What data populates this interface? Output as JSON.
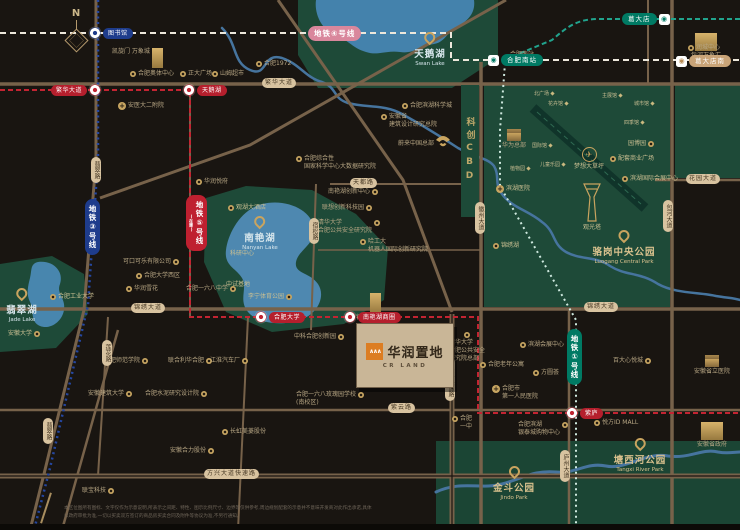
{
  "title": "华润置地 合肥区位图",
  "compass": "N",
  "project": {
    "name": "华润置地",
    "en": "CR LAND",
    "logo_mark": "∧∧∧"
  },
  "banner": {
    "text": "科创CBD"
  },
  "colors": {
    "background": "#191511",
    "park_green": "#1e4a38",
    "lake_blue": "#4886ae",
    "road_tan": "#77624a",
    "pill_tan": "#d8c3a0",
    "gold": "#c9a45f",
    "line1_teal": "#007a64",
    "line3_blue": "#1e3c8c",
    "line4_pink": "#d9879c",
    "line5_red": "#bf2030"
  },
  "metro_labels": [
    {
      "t": "地铁④号线",
      "x": 308,
      "y": 26,
      "v": 0,
      "color": "#d9879c"
    },
    {
      "t": "地铁③号线",
      "x": 85,
      "y": 199,
      "v": 1,
      "color": "#1e3c8c"
    },
    {
      "t": "地铁⑤号线",
      "sub": "(在建)",
      "x": 186,
      "y": 195,
      "v": 1,
      "color": "#bf2030"
    },
    {
      "t": "地铁①号线",
      "x": 567,
      "y": 329,
      "v": 1,
      "color": "#007a64"
    }
  ],
  "road_labels": [
    {
      "t": "繁华大道",
      "x": 262,
      "y": 78,
      "v": 0
    },
    {
      "t": "锦绣大道",
      "x": 131,
      "y": 303,
      "v": 0
    },
    {
      "t": "锦绣大道",
      "x": 584,
      "y": 302,
      "v": 0
    },
    {
      "t": "花园大道",
      "x": 686,
      "y": 174,
      "v": 0
    },
    {
      "t": "天都路",
      "x": 350,
      "y": 178,
      "v": 0
    },
    {
      "t": "紫云路",
      "x": 388,
      "y": 403,
      "v": 0
    },
    {
      "t": "方兴大道快速路",
      "x": 204,
      "y": 469,
      "v": 0
    },
    {
      "t": "翡翠路",
      "x": 91,
      "y": 157,
      "v": 1
    },
    {
      "t": "莲花路",
      "x": 102,
      "y": 340,
      "v": 1
    },
    {
      "t": "翡翠路",
      "x": 43,
      "y": 418,
      "v": 1
    },
    {
      "t": "宿松路",
      "x": 309,
      "y": 218,
      "v": 1
    },
    {
      "t": "宿松路快速路",
      "x": 445,
      "y": 357,
      "v": 1
    },
    {
      "t": "徽州大道",
      "x": 475,
      "y": 202,
      "v": 1
    },
    {
      "t": "包河大道",
      "x": 663,
      "y": 200,
      "v": 1
    },
    {
      "t": "庐州大道",
      "x": 560,
      "y": 450,
      "v": 1
    }
  ],
  "stations": [
    {
      "n": "图书馆",
      "x": 95,
      "y": 33,
      "k": "blue",
      "side": "r"
    },
    {
      "n": "繁华大道",
      "x": 95,
      "y": 90,
      "k": "red",
      "side": "l"
    },
    {
      "n": "天鹅湖",
      "x": 189,
      "y": 90,
      "k": "red",
      "side": "r"
    },
    {
      "n": "合肥大学",
      "x": 261,
      "y": 317,
      "k": "red",
      "side": "r"
    },
    {
      "n": "南艳湖商圈",
      "x": 350,
      "y": 317,
      "k": "red",
      "side": "r"
    },
    {
      "n": "紫庐",
      "x": 572,
      "y": 413,
      "k": "red",
      "side": "r"
    },
    {
      "n": "葛大店",
      "x": 622,
      "y": 13,
      "k": "teal",
      "side": "badge-r"
    },
    {
      "n": "合肥南站",
      "x": 488,
      "y": 54,
      "k": "teal",
      "side": "badge-l"
    },
    {
      "n": "葛大店南",
      "x": 676,
      "y": 55,
      "k": "tan",
      "side": "badge-l"
    }
  ],
  "area_names": [
    {
      "t": "天鹅湖",
      "en": "Swan Lake",
      "x": 430,
      "y": 30,
      "c": "blue"
    },
    {
      "t": "南艳湖",
      "en": "Nanyan Lake",
      "x": 260,
      "y": 214,
      "c": "blue"
    },
    {
      "t": "翡翠湖",
      "en": "Jade Lake",
      "x": 22,
      "y": 286,
      "c": "blue"
    },
    {
      "t": "骆岗中央公园",
      "en": "Luogang Central Park",
      "x": 624,
      "y": 228,
      "c": "gold"
    },
    {
      "t": "塘西河公园",
      "en": "Tangxi River Park",
      "x": 640,
      "y": 436,
      "c": "gold"
    },
    {
      "t": "金斗公园",
      "en": "Jindo Park",
      "x": 514,
      "y": 464,
      "c": "gold"
    }
  ],
  "pois": [
    {
      "l": [
        "凯旋门 万象城"
      ],
      "x": 112,
      "y": 48,
      "i": "bldg-tall",
      "s": "r"
    },
    {
      "l": [
        "合肥奥体中心"
      ],
      "x": 130,
      "y": 70,
      "i": "dot",
      "s": "l"
    },
    {
      "l": [
        "正大广场"
      ],
      "x": 180,
      "y": 70,
      "i": "dot",
      "s": "l"
    },
    {
      "l": [
        "山姆超市"
      ],
      "x": 212,
      "y": 70,
      "i": "dot",
      "s": "l"
    },
    {
      "l": [
        "安医大二附院"
      ],
      "x": 118,
      "y": 102,
      "i": "cross",
      "s": "l"
    },
    {
      "l": [
        "合肥1972"
      ],
      "x": 256,
      "y": 60,
      "i": "dot",
      "s": "l"
    },
    {
      "l": [
        "合肥滨湖科学城"
      ],
      "x": 402,
      "y": 102,
      "i": "dot",
      "s": "l"
    },
    {
      "l": [
        "安徽省",
        "建筑设计研究总院"
      ],
      "x": 381,
      "y": 113,
      "i": "dot",
      "s": "l"
    },
    {
      "l": [
        "蔚来中国总部"
      ],
      "x": 398,
      "y": 140,
      "i": "none",
      "s": "l"
    },
    {
      "l": [
        "合肥综合性",
        "国家科学中心大数据研究院"
      ],
      "x": 296,
      "y": 155,
      "i": "dot",
      "s": "l"
    },
    {
      "l": [
        "合肥南站"
      ],
      "x": 522,
      "y": 39,
      "i": "bldg-wide",
      "s": "t"
    },
    {
      "l": [
        "包河万象汇"
      ],
      "x": 706,
      "y": 33,
      "i": "bldg-big",
      "s": "t"
    },
    {
      "l": [
        "润城中心"
      ],
      "x": 688,
      "y": 44,
      "i": "dot",
      "s": "l"
    },
    {
      "l": [
        "华为总部"
      ],
      "x": 514,
      "y": 129,
      "i": "bldg",
      "s": "t"
    },
    {
      "l": [
        "可口可乐有限公司"
      ],
      "x": 123,
      "y": 258,
      "i": "dot",
      "s": "r"
    },
    {
      "l": [
        "合肥大学西区"
      ],
      "x": 136,
      "y": 272,
      "i": "dot",
      "s": "l"
    },
    {
      "l": [
        "华润雪花"
      ],
      "x": 126,
      "y": 285,
      "i": "dot",
      "s": "l"
    },
    {
      "l": [
        "合肥工业大学"
      ],
      "x": 50,
      "y": 293,
      "i": "dot",
      "s": "l",
      "g": 1
    },
    {
      "l": [
        "安徽大学"
      ],
      "x": 8,
      "y": 330,
      "i": "dot",
      "s": "r",
      "g": 1
    },
    {
      "l": [
        "华润悦府"
      ],
      "x": 196,
      "y": 178,
      "i": "dot",
      "s": "l"
    },
    {
      "l": [
        "观湖大酒店"
      ],
      "x": 228,
      "y": 204,
      "i": "dot",
      "s": "l",
      "g": 1
    },
    {
      "l": [
        "科研中心"
      ],
      "x": 230,
      "y": 250,
      "i": "none",
      "s": "l",
      "g": 1
    },
    {
      "l": [
        "中试基地"
      ],
      "x": 226,
      "y": 281,
      "i": "none",
      "s": "l",
      "g": 1
    },
    {
      "l": [
        "合肥一六八中学"
      ],
      "x": 186,
      "y": 285,
      "i": "dot",
      "s": "r"
    },
    {
      "l": [
        "李宁体育公园"
      ],
      "x": 248,
      "y": 293,
      "i": "dot",
      "s": "r",
      "g": 1
    },
    {
      "l": [
        "中科合肥创新园"
      ],
      "x": 294,
      "y": 333,
      "i": "dot",
      "s": "r"
    },
    {
      "l": [
        "南艳湖创新中心"
      ],
      "x": 328,
      "y": 188,
      "i": "dot",
      "s": "r"
    },
    {
      "l": [
        "联想创新科技园"
      ],
      "x": 322,
      "y": 204,
      "i": "dot",
      "s": "r"
    },
    {
      "l": [
        "清华大学",
        "合肥公共安全研究院"
      ],
      "x": 318,
      "y": 219,
      "i": "dot",
      "s": "r"
    },
    {
      "l": [
        "哈工大",
        "机器人国际创新研究院"
      ],
      "x": 360,
      "y": 238,
      "i": "dot",
      "s": "l"
    },
    {
      "l": [
        "银泰IN PARK!"
      ],
      "x": 375,
      "y": 293,
      "i": "bldg-tall",
      "s": "t"
    },
    {
      "l": [
        "清华大学",
        "合肥公共安全",
        "研究院总部"
      ],
      "x": 467,
      "y": 331,
      "i": "dot",
      "s": "t"
    },
    {
      "l": [
        "合肥一六八玫瑰园学校"
      ],
      "x": 372,
      "y": 379,
      "i": "dot",
      "s": "r"
    },
    {
      "l": [
        "合肥一六八玫瑰园学校",
        "(南校区)"
      ],
      "x": 296,
      "y": 391,
      "i": "dot",
      "s": "r"
    },
    {
      "l": [
        "合肥老年公寓"
      ],
      "x": 480,
      "y": 361,
      "i": "dot",
      "s": "l"
    },
    {
      "l": [
        "合肥市",
        "第一人民医院"
      ],
      "x": 492,
      "y": 385,
      "i": "cross",
      "s": "l"
    },
    {
      "l": [
        "合肥",
        "一中"
      ],
      "x": 452,
      "y": 415,
      "i": "dot",
      "s": "l"
    },
    {
      "l": [
        "滨湖会展中心"
      ],
      "x": 520,
      "y": 341,
      "i": "dot",
      "s": "l"
    },
    {
      "l": [
        "方圆荟"
      ],
      "x": 533,
      "y": 369,
      "i": "dot",
      "s": "l"
    },
    {
      "l": [
        "百大心悦城"
      ],
      "x": 613,
      "y": 357,
      "i": "dot",
      "s": "r"
    },
    {
      "l": [
        "安徽省立医院"
      ],
      "x": 712,
      "y": 355,
      "i": "bldg",
      "s": "t"
    },
    {
      "l": [
        "悦方ID MALL"
      ],
      "x": 594,
      "y": 419,
      "i": "dot",
      "s": "l"
    },
    {
      "l": [
        "合肥滨湖",
        "银泰城购物中心"
      ],
      "x": 518,
      "y": 421,
      "i": "dot",
      "s": "r"
    },
    {
      "l": [
        "安徽省政府"
      ],
      "x": 712,
      "y": 422,
      "i": "bldg-big",
      "s": "t"
    },
    {
      "l": [
        "合肥师范学院"
      ],
      "x": 104,
      "y": 357,
      "i": "dot",
      "s": "r"
    },
    {
      "l": [
        "联合利华合肥"
      ],
      "x": 168,
      "y": 357,
      "i": "dot",
      "s": "r"
    },
    {
      "l": [
        "江淮汽车厂"
      ],
      "x": 210,
      "y": 357,
      "i": "dot",
      "s": "r"
    },
    {
      "l": [
        "安徽建筑大学"
      ],
      "x": 88,
      "y": 390,
      "i": "dot",
      "s": "r"
    },
    {
      "l": [
        "合肥水泥研究设计院"
      ],
      "x": 145,
      "y": 390,
      "i": "dot",
      "s": "r"
    },
    {
      "l": [
        "长虹美菱股份"
      ],
      "x": 222,
      "y": 428,
      "i": "dot",
      "s": "l"
    },
    {
      "l": [
        "安徽合力股份"
      ],
      "x": 170,
      "y": 447,
      "i": "dot",
      "s": "r"
    },
    {
      "l": [
        "联宝科技"
      ],
      "x": 82,
      "y": 487,
      "i": "dot",
      "s": "r"
    },
    {
      "l": [
        "滨湖医院"
      ],
      "x": 496,
      "y": 185,
      "i": "cross",
      "s": "l",
      "g": 1
    },
    {
      "l": [
        "锦绣湖"
      ],
      "x": 493,
      "y": 242,
      "i": "dot",
      "s": "l",
      "g": 1
    },
    {
      "l": [
        "园博园"
      ],
      "x": 628,
      "y": 140,
      "i": "dot",
      "s": "r",
      "g": 1
    },
    {
      "l": [
        "配套商业广场"
      ],
      "x": 610,
      "y": 155,
      "i": "dot",
      "s": "l",
      "g": 1
    },
    {
      "l": [
        "滨湖国际会展中心"
      ],
      "x": 622,
      "y": 175,
      "i": "dot",
      "s": "l",
      "g": 1
    },
    {
      "l": [
        "梦想大草坪"
      ],
      "x": 589,
      "y": 147,
      "i": "plane",
      "s": "t",
      "g": 1
    },
    {
      "l": [
        "观光塔"
      ],
      "x": 592,
      "y": 224,
      "i": "none",
      "s": "t",
      "g": 1
    }
  ],
  "park_features": [
    {
      "t": "北广场",
      "x": 534,
      "y": 90
    },
    {
      "t": "花卉馆",
      "x": 548,
      "y": 100
    },
    {
      "t": "主展馆",
      "x": 602,
      "y": 92
    },
    {
      "t": "城市馆",
      "x": 634,
      "y": 100
    },
    {
      "t": "四季馆",
      "x": 624,
      "y": 119
    },
    {
      "t": "国际馆",
      "x": 532,
      "y": 142
    },
    {
      "t": "儿童乐园",
      "x": 540,
      "y": 161
    },
    {
      "t": "植物园",
      "x": 510,
      "y": 165
    }
  ],
  "nio_label": "蔚来中国总部",
  "disclaimer": {
    "line1": "本区位图所有图标、文字仅作为示意说明,所表示之间距、特性、图示比例尺寸、边界等仅供参考,周边规划配套的示意并不意味开发商对此作出承诺,具体",
    "line2": "以政府审批为准,一切以买卖双方签订的商品房买卖合同及附件等协议为准,不另行通知。"
  }
}
